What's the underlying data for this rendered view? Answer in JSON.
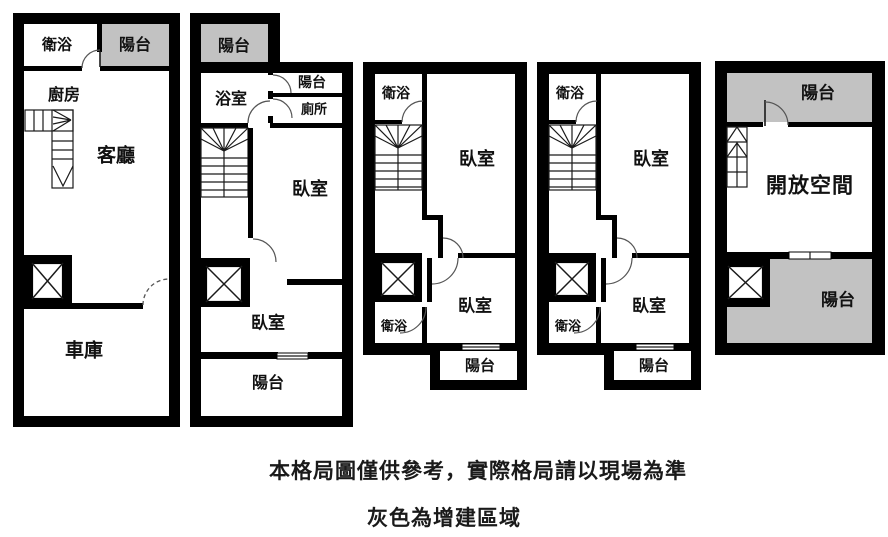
{
  "diagram": {
    "type": "floor-plan",
    "notes": {
      "line1": "本格局圖僅供參考，實際格局請以現場為準",
      "line2": "灰色為增建區域"
    },
    "colors": {
      "wall": "#000000",
      "addition_gray": "#c2c2c2",
      "background": "#ffffff",
      "text": "#111111"
    }
  },
  "floors": [
    {
      "id": "floor-1",
      "rooms": [
        {
          "key": "bathroom",
          "label": "衛浴"
        },
        {
          "key": "balcony",
          "label": "陽台",
          "addition": true
        },
        {
          "key": "kitchen",
          "label": "廚房"
        },
        {
          "key": "living-room",
          "label": "客廳"
        },
        {
          "key": "garage",
          "label": "車庫"
        }
      ]
    },
    {
      "id": "floor-2",
      "rooms": [
        {
          "key": "balcony-top",
          "label": "陽台",
          "addition": true
        },
        {
          "key": "bathroom",
          "label": "浴室"
        },
        {
          "key": "balcony-small",
          "label": "陽台"
        },
        {
          "key": "toilet",
          "label": "廁所"
        },
        {
          "key": "bedroom-upper",
          "label": "臥室"
        },
        {
          "key": "bedroom-lower",
          "label": "臥室"
        },
        {
          "key": "balcony-bottom",
          "label": "陽台"
        }
      ]
    },
    {
      "id": "floor-3",
      "rooms": [
        {
          "key": "bathroom-top",
          "label": "衛浴"
        },
        {
          "key": "bedroom-upper",
          "label": "臥室"
        },
        {
          "key": "bathroom-lower",
          "label": "衛浴"
        },
        {
          "key": "bedroom-lower",
          "label": "臥室"
        },
        {
          "key": "balcony",
          "label": "陽台"
        }
      ]
    },
    {
      "id": "floor-4",
      "rooms": [
        {
          "key": "bathroom-top",
          "label": "衛浴"
        },
        {
          "key": "bedroom-upper",
          "label": "臥室"
        },
        {
          "key": "bathroom-lower",
          "label": "衛浴"
        },
        {
          "key": "bedroom-lower",
          "label": "臥室"
        },
        {
          "key": "balcony",
          "label": "陽台"
        }
      ]
    },
    {
      "id": "floor-5",
      "rooms": [
        {
          "key": "balcony-top",
          "label": "陽台",
          "addition": true
        },
        {
          "key": "open-space",
          "label": "開放空間"
        },
        {
          "key": "balcony-bottom",
          "label": "陽台",
          "addition": true
        }
      ]
    }
  ]
}
